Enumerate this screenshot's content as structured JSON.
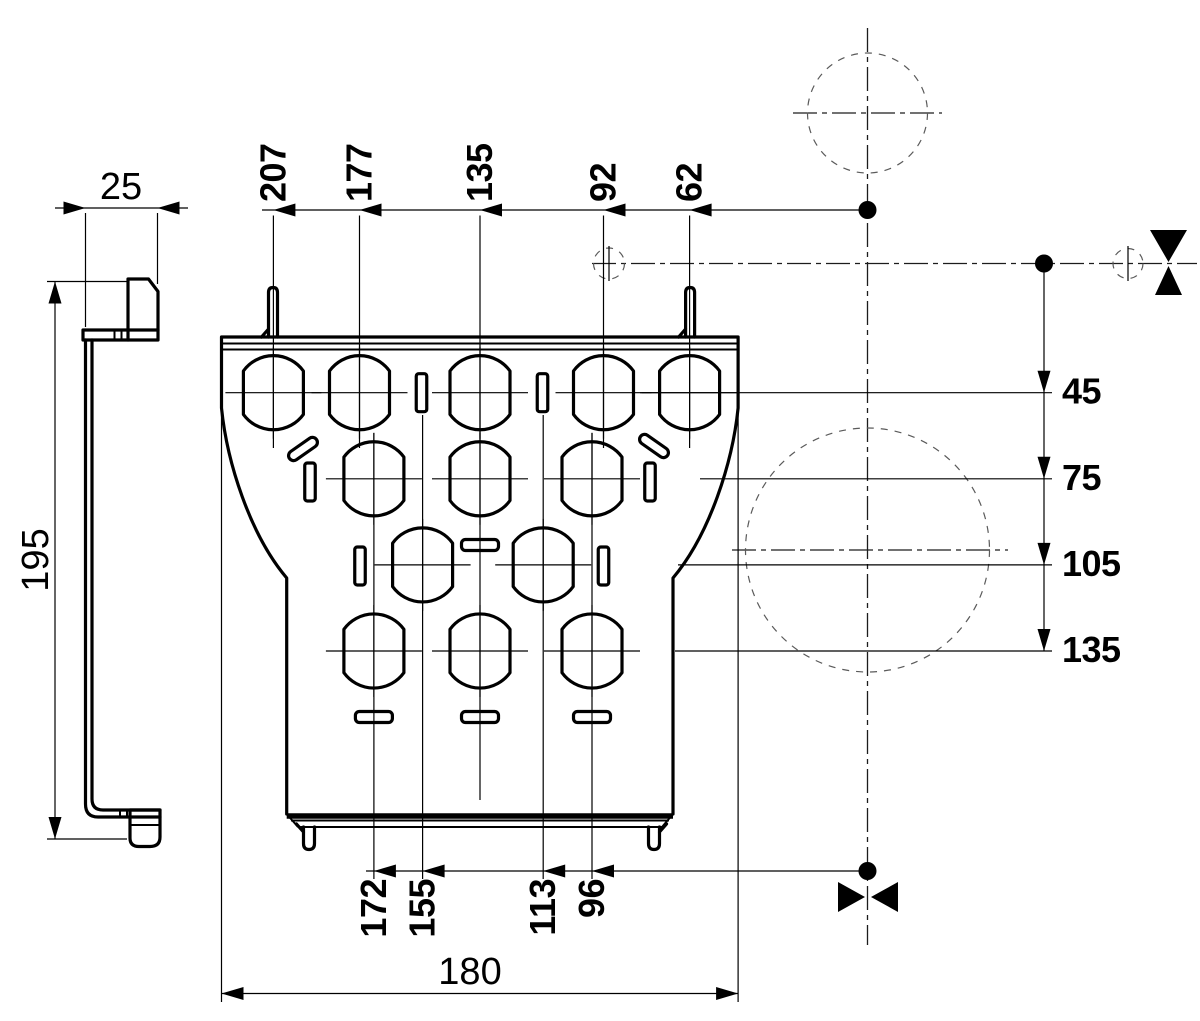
{
  "colors": {
    "ink": "#000000",
    "background": "#ffffff",
    "reference": "#5a5a5a"
  },
  "dims": {
    "side_depth": "25",
    "side_height": "195",
    "front_width": "180",
    "top": [
      "207",
      "177",
      "135",
      "92",
      "62"
    ],
    "bottom": [
      "172",
      "155",
      "113",
      "96"
    ],
    "right": [
      "45",
      "75",
      "105",
      "135"
    ]
  }
}
